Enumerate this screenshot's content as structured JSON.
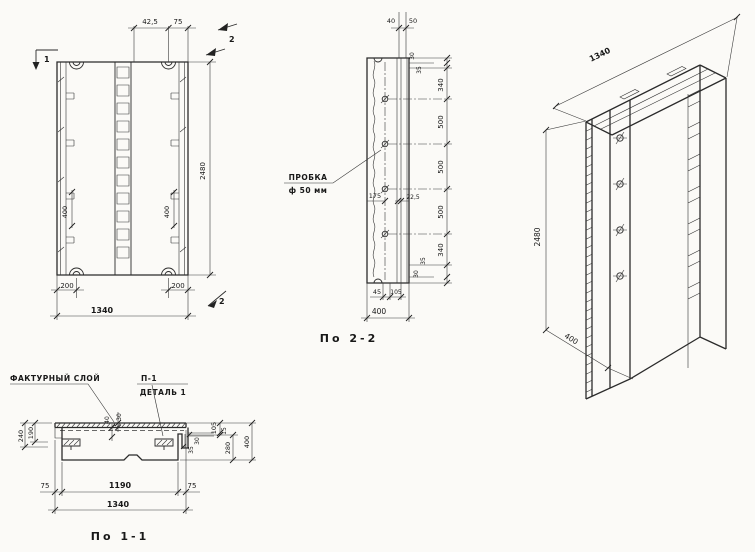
{
  "front": {
    "flag_top_left": "1",
    "flag_top_right": "2",
    "flag_bottom_right": "2",
    "dim_top_a": "42,5",
    "dim_top_b": "75",
    "dim_height": "2480",
    "dim_hook_left": "400",
    "dim_hook_right": "400",
    "dim_bottom_left": "200",
    "dim_bottom_right": "200",
    "dim_width": "1340"
  },
  "section22": {
    "title": "По 2-2",
    "probka_line1": "ПРОБКА",
    "probka_line2": "ф 50 мм",
    "dim_top_a": "40",
    "dim_top_b": "50",
    "right_dims": [
      "30",
      "35",
      "340",
      "500",
      "500",
      "500",
      "340",
      "35",
      "30"
    ],
    "dim_inner_a": "175",
    "dim_inner_b": "22,5",
    "dim_bottom_a": "45",
    "dim_bottom_b": "105",
    "dim_bottom_total": "400"
  },
  "iso": {
    "dim_width": "1340",
    "dim_height": "2480",
    "dim_depth": "400"
  },
  "section11": {
    "title": "По 1-1",
    "label_factura": "ФАКТУРНЫЙ СЛОЙ",
    "label_p1": "П-1",
    "label_detail": "ДЕТАЛЬ 1",
    "dim_left_inner": "190",
    "dim_left_outer": "240",
    "dim_mid_a": "30",
    "dim_mid_b": "40",
    "dim_right_a": "105",
    "dim_right_b": "15",
    "dim_right_c": "280",
    "dim_right_total": "400",
    "dim_end_a": "30",
    "dim_end_b": "35",
    "dim_bottom_left": "75",
    "dim_bottom_mid": "1190",
    "dim_bottom_right": "75",
    "dim_bottom_total": "1340"
  },
  "colors": {
    "ink": "#2b2b2b",
    "paper": "#fbfaf7"
  }
}
